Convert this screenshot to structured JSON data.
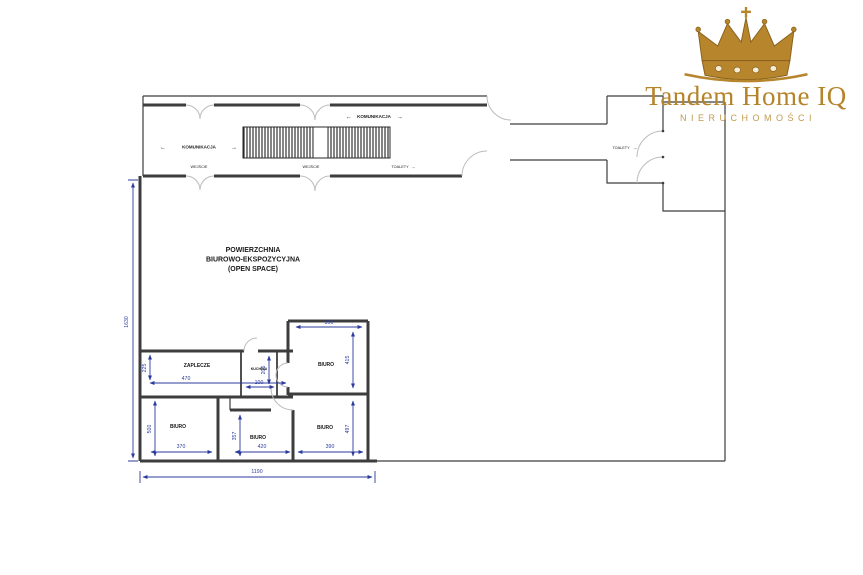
{
  "logo": {
    "brand": "Tandem Home IQ",
    "subtitle": "NIERUCHOMOŚCI"
  },
  "corridor": {
    "komunikacja": "KOMUNIKACJA",
    "arrow_left": "←",
    "arrow_right": "→",
    "wejscie": "WEJŚCIE",
    "toalety": "TOALETY"
  },
  "rooms": {
    "open_space_line1": "POWIERZCHNIA",
    "open_space_line2": "BIUROWO-EKSPOZYCYJNA",
    "open_space_line3": "(OPEN SPACE)",
    "zaplecze": "ZAPLECZE",
    "kuchnia": "KUCHNIA",
    "biuro": "BIURO"
  },
  "dims": {
    "total_h": "1630",
    "total_w": "1190",
    "zaplecze_w": "470",
    "zaplecze_h": "225",
    "kuchnia_w": "100",
    "kuchnia_h": "205",
    "biuro_tr_w": "390",
    "biuro_tr_h": "415",
    "biuro_bl_w": "370",
    "biuro_bl_h": "500",
    "biuro_bm_w": "420",
    "biuro_bm_h": "357",
    "biuro_br_w": "390",
    "biuro_br_h": "497"
  },
  "colors": {
    "wall": "#3d3d3d",
    "dim": "#2b3a9e",
    "door": "#bcbcbc",
    "gold": "#b6852c",
    "gold_dark": "#8a621e",
    "gold_light": "#c39a4e"
  }
}
